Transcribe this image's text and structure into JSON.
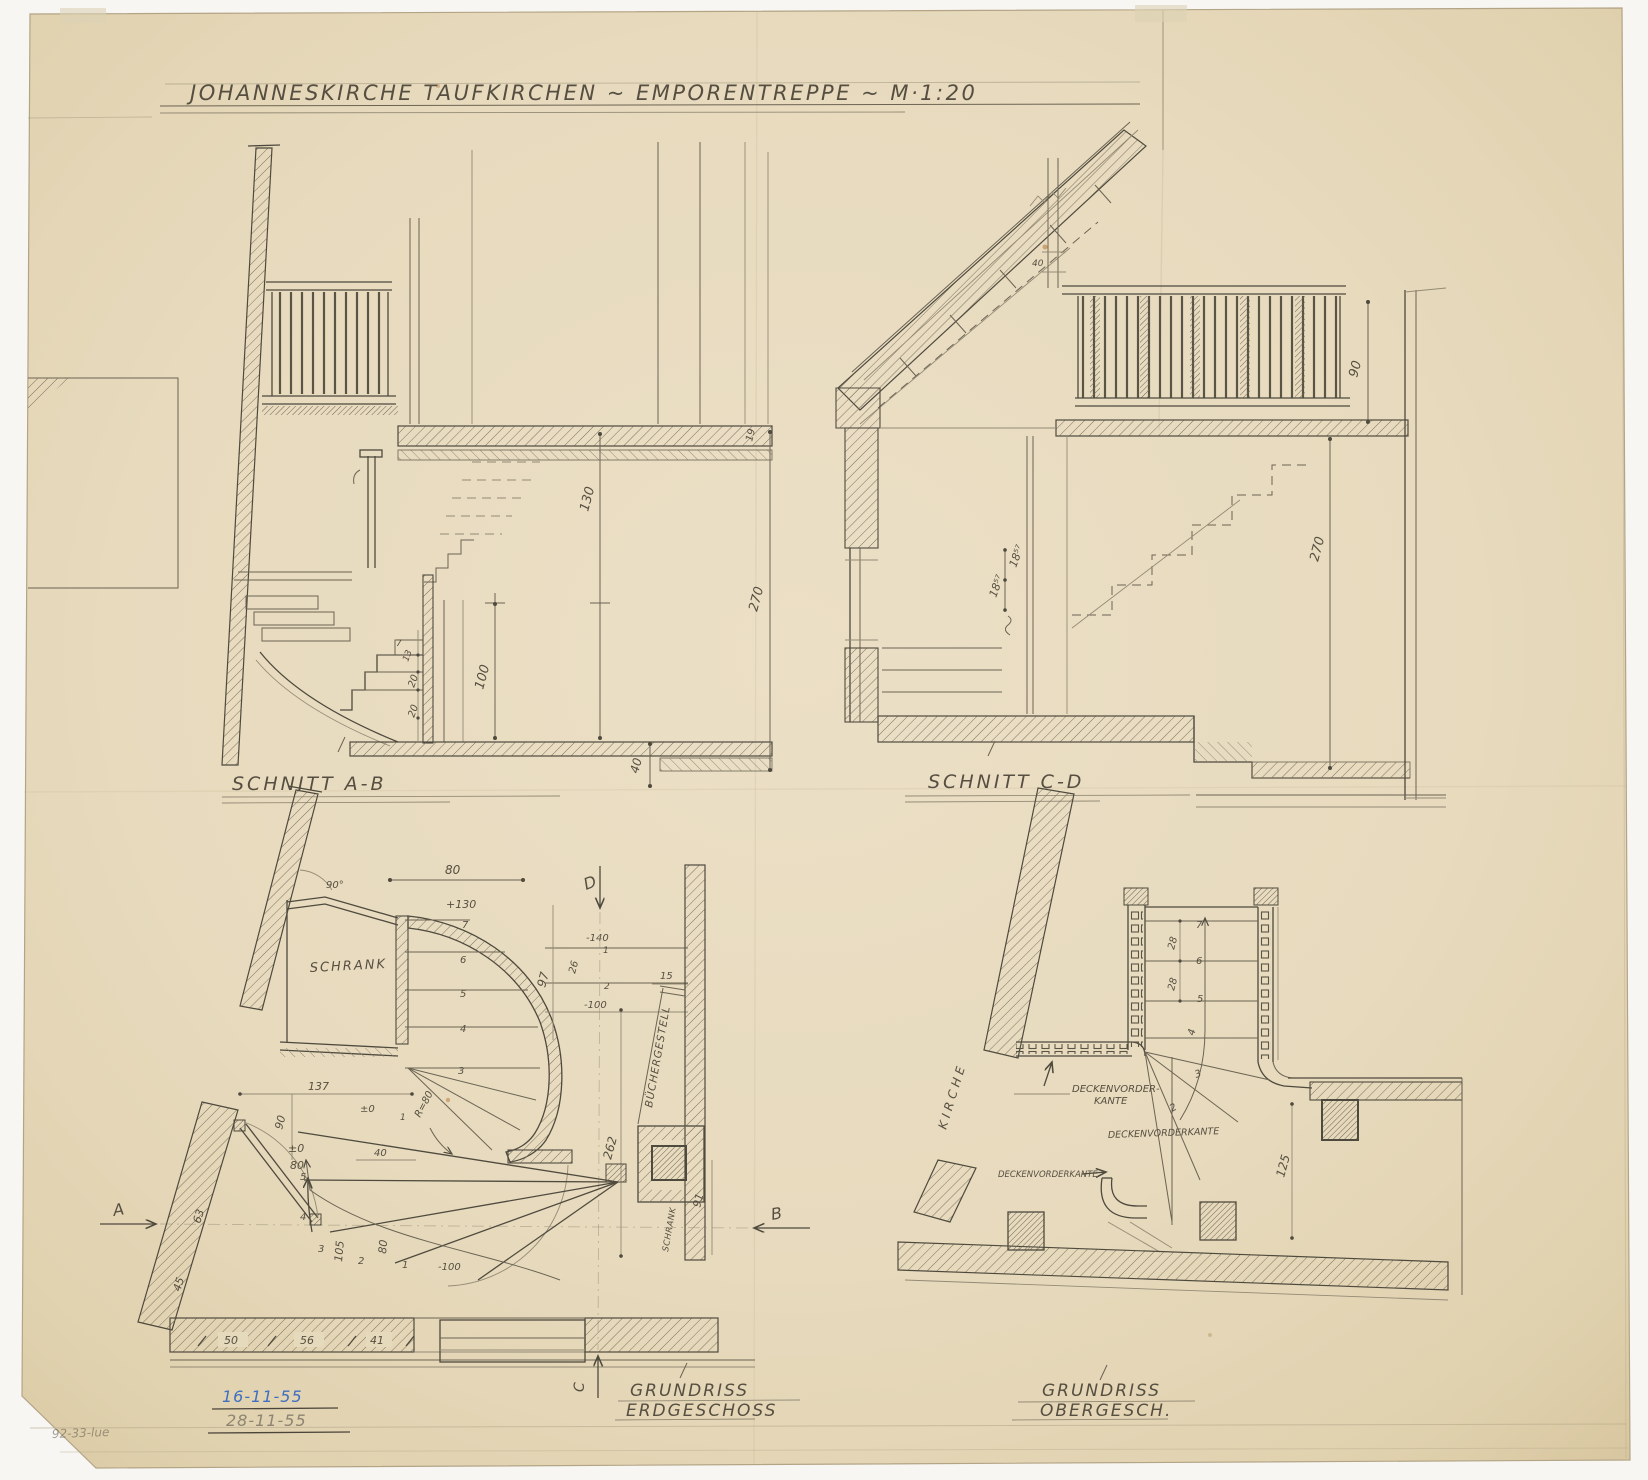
{
  "colors": {
    "paper": "#e8dcc0",
    "ink": "#4f4a3e",
    "pencil": "#8d8572",
    "stamp_blue": "#3f6fc0"
  },
  "title": {
    "text": "JOHANNESKIRCHE TAUFKIRCHEN ~ EMPORENTREPPE ~ M·1:20"
  },
  "ab": {
    "label": "SCHNITT A-B",
    "d19": "19",
    "d130": "130",
    "d270": "270",
    "d100": "100",
    "d40": "40",
    "d7": "7",
    "d13": "13",
    "d20a": "20",
    "d20b": "20"
  },
  "cd": {
    "label": "SCHNITT C-D",
    "d40": "40",
    "d90": "90",
    "d270": "270",
    "riser_a": "18⁵⁷",
    "riser_b": "18⁵⁷"
  },
  "gf": {
    "label_line1": "GRUNDRISS",
    "label_line2": "ERDGESCHOSS",
    "schrank": "SCHRANK",
    "schrank2": "SCHRANK",
    "buechergestell": "BÜCHERGESTELL",
    "angle90": "90°",
    "d80_top": "80",
    "lvl_p130": "+130",
    "d97": "97",
    "d26": "26",
    "lvl_m140": "-140",
    "d15": "15",
    "lvl_m100_a": "-100",
    "d262": "262",
    "d137": "137",
    "d90": "90",
    "lvl_0_a": "±0",
    "lvl_0_b": "±0",
    "d80_b": "80",
    "d40": "40",
    "r80": "R=80",
    "d63": "63",
    "d45": "45",
    "d105": "105",
    "d80_c": "80",
    "lvl_m100_b": "-100",
    "d91": "91",
    "d50": "50",
    "d56": "56",
    "d41": "41",
    "steps": {
      "s1": "1",
      "s2": "2",
      "s3": "3",
      "s4": "4",
      "s5": "5",
      "x1": "1",
      "u1": "1",
      "u2": "2",
      "c3": "3",
      "c4": "4",
      "c5": "5",
      "c6": "6",
      "c7": "7"
    },
    "sections": {
      "a": "A",
      "b": "B",
      "c": "C",
      "d": "D"
    }
  },
  "of": {
    "label_line1": "GRUNDRISS",
    "label_line2": "OBERGESCH.",
    "kirche": "KIRCHE",
    "deck_label_1a": "DECKENVORDER-",
    "deck_label_1b": "KANTE",
    "deck_label_2": "DECKENVORDERKANTE",
    "deck_label_3": "DECKENVORDERKANTE",
    "d125": "125",
    "d28_a": "28",
    "d28_b": "28",
    "steps": {
      "s2": "2",
      "s3": "3",
      "s4": "4",
      "s5": "5",
      "s6": "6",
      "s7": "7"
    }
  },
  "stamps": {
    "date_blue": "16-11-55",
    "date_pencil": "28-11-55"
  },
  "corner_mark": "92-33-lue"
}
